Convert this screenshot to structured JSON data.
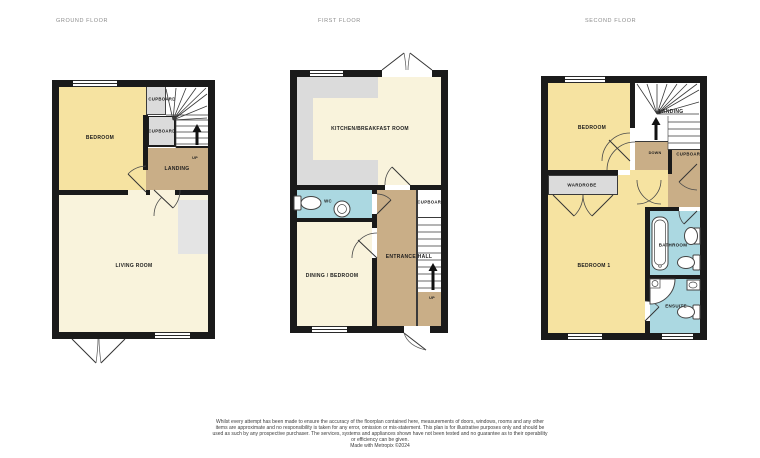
{
  "floors": {
    "ground": {
      "title": "GROUND FLOOR",
      "bedroom": "BEDROOM",
      "cupboard_top": "CUPBOARD",
      "cupboard_mid": "CUPBOARD",
      "landing": "LANDING",
      "living_room": "LIVING ROOM",
      "stairs_direction": "UP"
    },
    "first": {
      "title": "FIRST FLOOR",
      "kitchen": "KITCHEN/BREAKFAST ROOM",
      "wc": "WC",
      "dining": "DINING / BEDROOM",
      "entrance_hall": "ENTRANCE HALL",
      "cupboard": "CUPBOARD",
      "stairs_direction": "UP"
    },
    "second": {
      "title": "SECOND FLOOR",
      "bedroom": "BEDROOM",
      "landing": "LANDING",
      "stairs_direction": "DOWN",
      "cupboard": "CUPBOARD",
      "wardrobe": "WARDROBE",
      "bedroom1": "BEDROOM 1",
      "bathroom": "BATHROOM",
      "ensuite": "ENSUITE"
    }
  },
  "footer": {
    "disclaimer": "Whilst every attempt has been made to ensure the accuracy of the floorplan contained here, measurements of doors, windows, rooms and any other items are approximate and no responsibility is taken for any error, omission or mis-statement. This plan is for illustrative purposes only and should be used as such by any prospective purchaser. The services, systems and appliances shown have not been tested and no guarantee as to their operability or efficiency can be given.",
    "credit": "Made with Metropix ©2024"
  },
  "colors": {
    "wall": "#1a1a1a",
    "room_yellow": "#f6e3a1",
    "room_cream": "#f9f3dc",
    "hall_tan": "#c9ae87",
    "cupboard_grey": "#dbdbdb",
    "wet_blue": "#abd8e1",
    "void_grey": "#e4e4e4"
  }
}
